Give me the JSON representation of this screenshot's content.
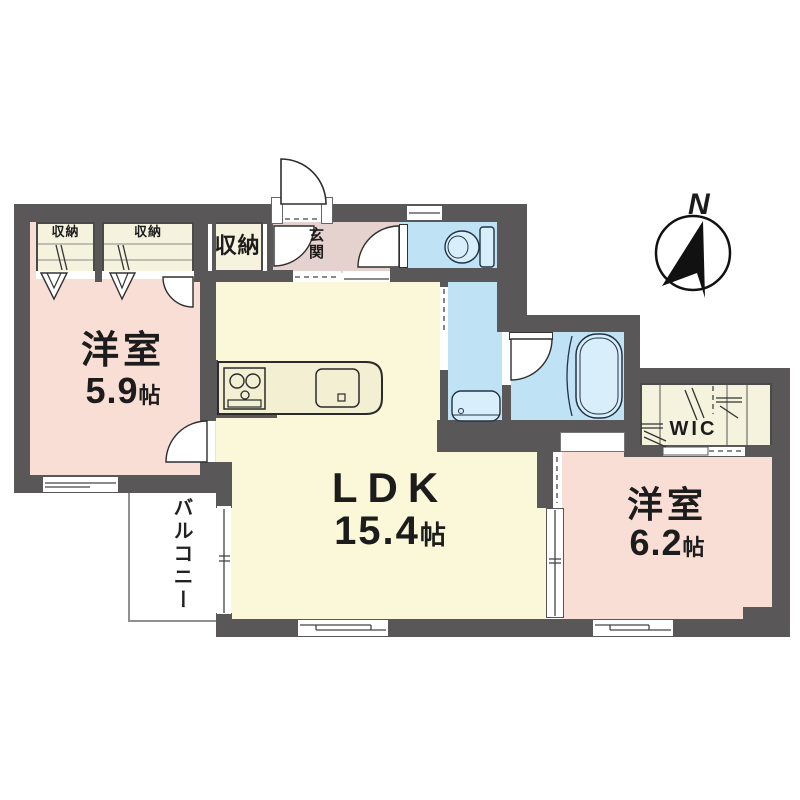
{
  "plan_title": "1LDK apartment floor plan",
  "compass": {
    "label": "N"
  },
  "rooms": {
    "bedroom1": {
      "name": "洋室",
      "size_value": "5.9",
      "size_unit": "帖"
    },
    "ldk": {
      "name": "LDK",
      "size_value": "15.4",
      "size_unit": "帖"
    },
    "bedroom2": {
      "name": "洋室",
      "size_value": "6.2",
      "size_unit": "帖"
    },
    "entrance": {
      "label": "玄関"
    },
    "wic": {
      "label": "WIC"
    },
    "balcony": {
      "label": "バルコニー"
    },
    "closet_small_1": {
      "label": "収納"
    },
    "closet_small_2": {
      "label": "収納"
    },
    "closet_hall": {
      "label": "収納"
    }
  },
  "colors": {
    "wall": "#595757",
    "bedroom_floor": "#f8ded4",
    "ldk_floor": "#faf8d8",
    "closet_floor": "#f5f2dd",
    "entrance_floor": "#e5d2ce",
    "wet_area_floor": "#bfe2f4",
    "fixture_fill": "#d9eefb",
    "balcony_outline": "#909090",
    "line": "#2e2e2e"
  }
}
